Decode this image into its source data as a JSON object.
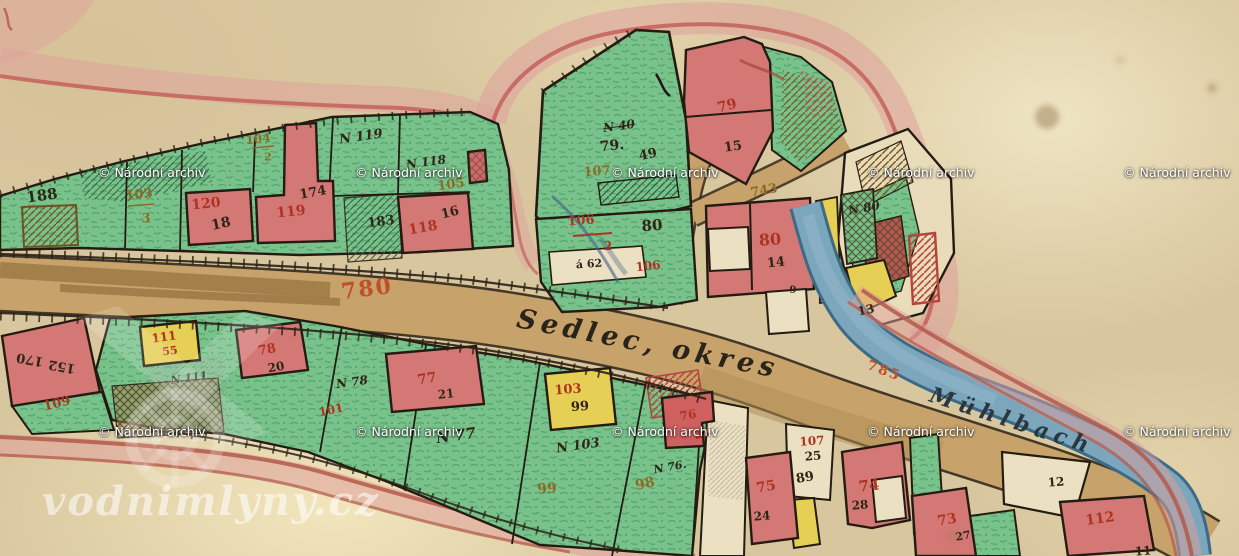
{
  "map": {
    "type": "historic cadastral map",
    "road_name": "Sedlec, okres",
    "stream_name": "Mühlbach",
    "road_parcel_number": "780",
    "stream_parcel_number": "785"
  },
  "colors": {
    "parcel_green": "#7ac28c",
    "building_red": "#d47876",
    "parcel_yellow": "#e6cf55",
    "road_tan": "#c7a36b",
    "stream_blue": "#7ba6bc",
    "ink_black": "#2a2014",
    "number_red": "#ae3322",
    "number_brown": "#8d6a24",
    "number_orange": "#c24e2c",
    "halo_pink": "#dfa09c"
  },
  "labels": [
    {
      "name": "parcel-label-188",
      "text": "188",
      "x": 42,
      "y": 196,
      "size": 15,
      "rot": -8,
      "cls": "lbl-black"
    },
    {
      "name": "parcel-label-103-num",
      "text": "103",
      "x": 139,
      "y": 195,
      "size": 13,
      "rot": -6,
      "cls": "lbl-brown"
    },
    {
      "name": "parcel-label-103-den",
      "text": "3",
      "x": 146,
      "y": 219,
      "size": 13,
      "rot": 0,
      "cls": "lbl-brown"
    },
    {
      "name": "parcel-label-120",
      "text": "120",
      "x": 206,
      "y": 204,
      "size": 14,
      "rot": -6,
      "cls": "lbl-red"
    },
    {
      "name": "house-label-18",
      "text": "18",
      "x": 221,
      "y": 224,
      "size": 14,
      "rot": -12,
      "cls": "lbl-black"
    },
    {
      "name": "parcel-label-104-num",
      "text": "104",
      "x": 258,
      "y": 139,
      "size": 12,
      "rot": -6,
      "cls": "lbl-brown"
    },
    {
      "name": "parcel-label-104-den",
      "text": "2",
      "x": 268,
      "y": 157,
      "size": 11,
      "rot": 0,
      "cls": "lbl-brown"
    },
    {
      "name": "house-label-174",
      "text": "174",
      "x": 313,
      "y": 193,
      "size": 13,
      "rot": -10,
      "cls": "lbl-black"
    },
    {
      "name": "parcel-label-119",
      "text": "119",
      "x": 291,
      "y": 212,
      "size": 14,
      "rot": -6,
      "cls": "lbl-red"
    },
    {
      "name": "parcel-label-n119",
      "text": "N 119",
      "x": 361,
      "y": 137,
      "size": 13,
      "rot": -8,
      "cls": "lbl-script"
    },
    {
      "name": "parcel-label-n118",
      "text": "N 118",
      "x": 426,
      "y": 162,
      "size": 12,
      "rot": -8,
      "cls": "lbl-script"
    },
    {
      "name": "parcel-label-105",
      "text": "105",
      "x": 451,
      "y": 185,
      "size": 13,
      "rot": -8,
      "cls": "lbl-brown"
    },
    {
      "name": "parcel-label-183",
      "text": "183",
      "x": 381,
      "y": 222,
      "size": 13,
      "rot": -8,
      "cls": "lbl-black"
    },
    {
      "name": "parcel-label-118",
      "text": "118",
      "x": 423,
      "y": 228,
      "size": 14,
      "rot": -10,
      "cls": "lbl-red"
    },
    {
      "name": "house-label-16",
      "text": "16",
      "x": 450,
      "y": 213,
      "size": 13,
      "rot": -14,
      "cls": "lbl-black"
    },
    {
      "name": "parcel-label-n40",
      "text": "N 40",
      "x": 619,
      "y": 126,
      "size": 12,
      "rot": -8,
      "cls": "lbl-script lbl-strike"
    },
    {
      "name": "parcel-label-79",
      "text": "79.",
      "x": 612,
      "y": 146,
      "size": 14,
      "rot": -6,
      "cls": "lbl-black"
    },
    {
      "name": "parcel-label-49",
      "text": "49",
      "x": 648,
      "y": 155,
      "size": 13,
      "rot": -12,
      "cls": "lbl-black"
    },
    {
      "name": "parcel-label-107",
      "text": "107",
      "x": 597,
      "y": 172,
      "size": 13,
      "rot": -4,
      "cls": "lbl-brown"
    },
    {
      "name": "parcel-label-106-num",
      "text": "106",
      "x": 581,
      "y": 221,
      "size": 13,
      "rot": -4,
      "cls": "lbl-red"
    },
    {
      "name": "parcel-label-106-den",
      "text": "2",
      "x": 608,
      "y": 246,
      "size": 12,
      "rot": 0,
      "cls": "lbl-red"
    },
    {
      "name": "parcel-label-80-black",
      "text": "80",
      "x": 652,
      "y": 226,
      "size": 15,
      "rot": -4,
      "cls": "lbl-black"
    },
    {
      "name": "note-label-a62",
      "text": "á 62",
      "x": 589,
      "y": 264,
      "size": 11,
      "rot": -4,
      "cls": "lbl-black"
    },
    {
      "name": "parcel-label-106b",
      "text": "106",
      "x": 648,
      "y": 266,
      "size": 12,
      "rot": -6,
      "cls": "lbl-red"
    },
    {
      "name": "parcel-label-79-red",
      "text": "79",
      "x": 727,
      "y": 106,
      "size": 14,
      "rot": -14,
      "cls": "lbl-red"
    },
    {
      "name": "house-label-15",
      "text": "15",
      "x": 733,
      "y": 147,
      "size": 13,
      "rot": -8,
      "cls": "lbl-black"
    },
    {
      "name": "road-label-743",
      "text": "743",
      "x": 764,
      "y": 191,
      "size": 13,
      "rot": -10,
      "cls": "lbl-brown"
    },
    {
      "name": "parcel-label-80-red",
      "text": "80",
      "x": 770,
      "y": 240,
      "size": 16,
      "rot": -4,
      "cls": "lbl-red"
    },
    {
      "name": "house-label-14",
      "text": "14",
      "x": 776,
      "y": 263,
      "size": 13,
      "rot": -6,
      "cls": "lbl-black"
    },
    {
      "name": "house-label-9",
      "text": "9",
      "x": 793,
      "y": 291,
      "size": 10,
      "rot": 0,
      "cls": "lbl-black"
    },
    {
      "name": "parcel-label-n80",
      "text": "N 80",
      "x": 864,
      "y": 208,
      "size": 12,
      "rot": -10,
      "cls": "lbl-script"
    },
    {
      "name": "house-label-13",
      "text": "13",
      "x": 866,
      "y": 310,
      "size": 12,
      "rot": -12,
      "cls": "lbl-black"
    },
    {
      "name": "road-label-780",
      "text": "780",
      "x": 367,
      "y": 289,
      "size": 22,
      "rot": -7,
      "cls": "lbl-orange"
    },
    {
      "name": "road-name-label",
      "text": "Sedlec, okres",
      "x": 648,
      "y": 344,
      "size": 27,
      "rot": 11,
      "cls": "lbl-script-lg"
    },
    {
      "name": "stream-label-785",
      "text": "785",
      "x": 884,
      "y": 371,
      "size": 14,
      "rot": 20,
      "cls": "lbl-orange"
    },
    {
      "name": "stream-name-label",
      "text": "Mühlbach",
      "x": 1012,
      "y": 421,
      "size": 22,
      "rot": 18,
      "cls": "lbl-script-blue"
    },
    {
      "name": "parcel-label-170",
      "text": "170",
      "x": 30,
      "y": 359,
      "size": 13,
      "rot": 190,
      "cls": "lbl-black"
    },
    {
      "name": "parcel-label-152",
      "text": "152",
      "x": 62,
      "y": 366,
      "size": 13,
      "rot": 190,
      "cls": "lbl-black"
    },
    {
      "name": "parcel-label-109",
      "text": "109",
      "x": 57,
      "y": 404,
      "size": 13,
      "rot": -14,
      "cls": "lbl-red"
    },
    {
      "name": "parcel-label-111",
      "text": "111",
      "x": 164,
      "y": 337,
      "size": 12,
      "rot": -8,
      "cls": "lbl-red"
    },
    {
      "name": "house-label-55",
      "text": "55",
      "x": 170,
      "y": 351,
      "size": 11,
      "rot": -8,
      "cls": "lbl-red"
    },
    {
      "name": "parcel-label-n111",
      "text": "N 111",
      "x": 189,
      "y": 378,
      "size": 11,
      "rot": -8,
      "cls": "lbl-script"
    },
    {
      "name": "parcel-label-78",
      "text": "78",
      "x": 267,
      "y": 350,
      "size": 13,
      "rot": -10,
      "cls": "lbl-red"
    },
    {
      "name": "house-label-20",
      "text": "20",
      "x": 276,
      "y": 367,
      "size": 12,
      "rot": -10,
      "cls": "lbl-black"
    },
    {
      "name": "parcel-label-n78",
      "text": "N 78",
      "x": 352,
      "y": 382,
      "size": 12,
      "rot": -8,
      "cls": "lbl-script"
    },
    {
      "name": "parcel-label-101",
      "text": "101",
      "x": 331,
      "y": 410,
      "size": 12,
      "rot": -12,
      "cls": "lbl-red"
    },
    {
      "name": "parcel-label-77",
      "text": "77",
      "x": 427,
      "y": 379,
      "size": 14,
      "rot": -10,
      "cls": "lbl-red"
    },
    {
      "name": "house-label-21",
      "text": "21",
      "x": 446,
      "y": 394,
      "size": 12,
      "rot": -6,
      "cls": "lbl-black"
    },
    {
      "name": "parcel-label-n77",
      "text": "N 77",
      "x": 456,
      "y": 436,
      "size": 15,
      "rot": -8,
      "cls": "lbl-script"
    },
    {
      "name": "parcel-label-103b",
      "text": "103",
      "x": 568,
      "y": 390,
      "size": 13,
      "rot": -4,
      "cls": "lbl-red"
    },
    {
      "name": "house-label-99",
      "text": "99",
      "x": 580,
      "y": 407,
      "size": 13,
      "rot": -4,
      "cls": "lbl-black"
    },
    {
      "name": "parcel-label-n103",
      "text": "N 103",
      "x": 578,
      "y": 446,
      "size": 13,
      "rot": -8,
      "cls": "lbl-script"
    },
    {
      "name": "parcel-label-99-brown",
      "text": "99",
      "x": 547,
      "y": 489,
      "size": 14,
      "rot": -4,
      "cls": "lbl-brown"
    },
    {
      "name": "parcel-label-98",
      "text": "98",
      "x": 645,
      "y": 484,
      "size": 14,
      "rot": -12,
      "cls": "lbl-brown"
    },
    {
      "name": "parcel-label-n76",
      "text": "N 76.",
      "x": 670,
      "y": 467,
      "size": 11,
      "rot": -10,
      "cls": "lbl-script"
    },
    {
      "name": "parcel-label-76",
      "text": "76",
      "x": 688,
      "y": 415,
      "size": 12,
      "rot": -10,
      "cls": "lbl-red"
    },
    {
      "name": "house-label-23",
      "text": "23",
      "x": 702,
      "y": 434,
      "size": 11,
      "rot": -12,
      "cls": "lbl-red"
    },
    {
      "name": "parcel-label-75",
      "text": "75",
      "x": 766,
      "y": 487,
      "size": 14,
      "rot": -10,
      "cls": "lbl-red"
    },
    {
      "name": "house-label-24",
      "text": "24",
      "x": 762,
      "y": 516,
      "size": 12,
      "rot": -4,
      "cls": "lbl-black"
    },
    {
      "name": "parcel-label-107b",
      "text": "107",
      "x": 812,
      "y": 441,
      "size": 12,
      "rot": -4,
      "cls": "lbl-red"
    },
    {
      "name": "house-label-25",
      "text": "25",
      "x": 813,
      "y": 456,
      "size": 12,
      "rot": -4,
      "cls": "lbl-black"
    },
    {
      "name": "house-label-89",
      "text": "89",
      "x": 805,
      "y": 478,
      "size": 13,
      "rot": -10,
      "cls": "lbl-black"
    },
    {
      "name": "parcel-label-74",
      "text": "74",
      "x": 869,
      "y": 486,
      "size": 15,
      "rot": -6,
      "cls": "lbl-red"
    },
    {
      "name": "house-label-28",
      "text": "28",
      "x": 860,
      "y": 505,
      "size": 12,
      "rot": -4,
      "cls": "lbl-black"
    },
    {
      "name": "parcel-label-73",
      "text": "73",
      "x": 947,
      "y": 520,
      "size": 14,
      "rot": -10,
      "cls": "lbl-red"
    },
    {
      "name": "house-label-27",
      "text": "27",
      "x": 963,
      "y": 536,
      "size": 11,
      "rot": -10,
      "cls": "lbl-black"
    },
    {
      "name": "parcel-label-12",
      "text": "12",
      "x": 1056,
      "y": 482,
      "size": 12,
      "rot": -4,
      "cls": "lbl-black"
    },
    {
      "name": "parcel-label-112",
      "text": "112",
      "x": 1100,
      "y": 519,
      "size": 14,
      "rot": -8,
      "cls": "lbl-red"
    },
    {
      "name": "parcel-label-11",
      "text": "11",
      "x": 1143,
      "y": 551,
      "size": 12,
      "rot": -4,
      "cls": "lbl-black"
    }
  ],
  "watermarks": {
    "archive_text": "© Národní archiv",
    "positions": [
      {
        "x": 98,
        "y": 165
      },
      {
        "x": 355,
        "y": 165
      },
      {
        "x": 611,
        "y": 165
      },
      {
        "x": 867,
        "y": 165
      },
      {
        "x": 1123,
        "y": 165
      },
      {
        "x": 98,
        "y": 424
      },
      {
        "x": 355,
        "y": 424
      },
      {
        "x": 611,
        "y": 424
      },
      {
        "x": 867,
        "y": 424
      },
      {
        "x": 1123,
        "y": 424
      }
    ],
    "site_text": "vodnimlyny.cz",
    "site_x": 42,
    "site_y": 478
  }
}
